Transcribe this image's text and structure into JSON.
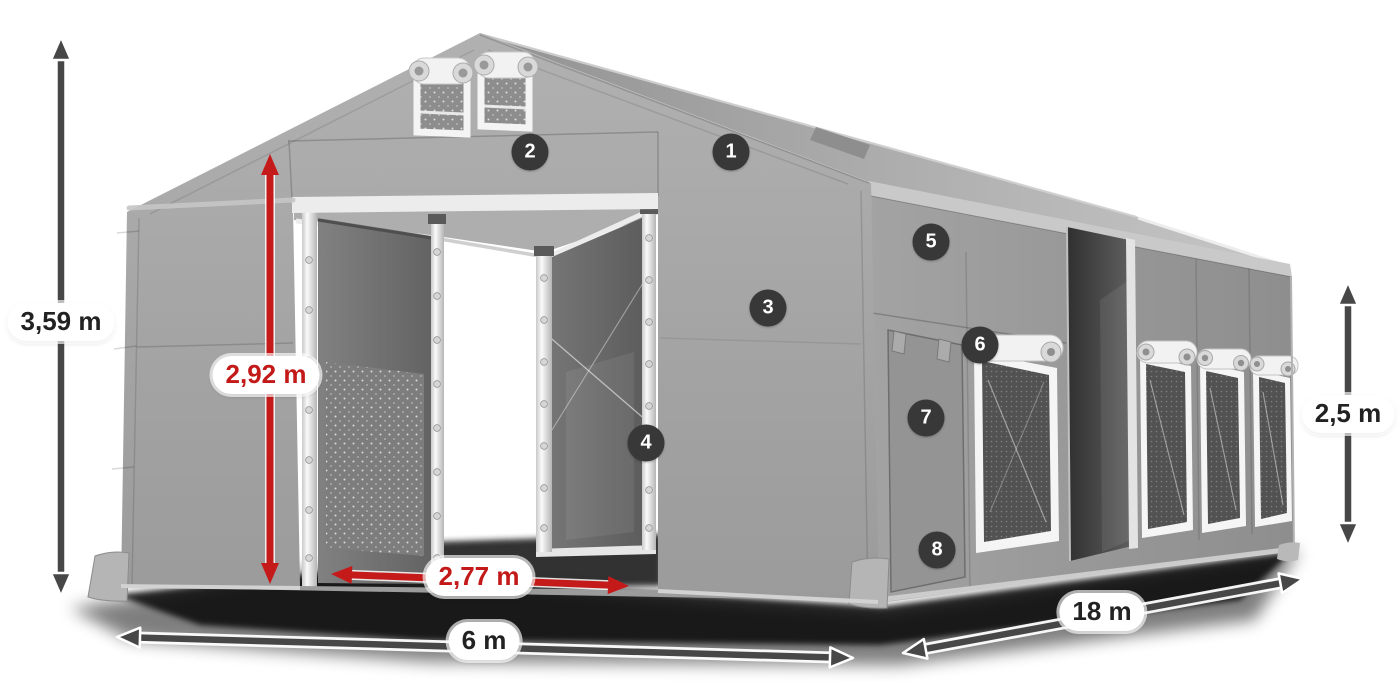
{
  "colors": {
    "accent_red": "#c51a1a",
    "arrow_dark": "#474747",
    "badge_background": "#383838",
    "badge_text": "#ffffff",
    "label_background": "#ffffff",
    "label_text": "#222222",
    "tent_gray": "#a6a6a6"
  },
  "icons": {
    "dimension_arrow_vertical": "↕",
    "dimension_arrow_horizontal": "↔"
  },
  "dimension_labels": {
    "total_height": "3,59 m",
    "entrance_height": "2,92 m",
    "entrance_width": "2,77 m",
    "front_width": "6 m",
    "side_length": "18 m",
    "side_wall_height": "2,5 m"
  },
  "feature_badges": [
    {
      "number": "1"
    },
    {
      "number": "2"
    },
    {
      "number": "3"
    },
    {
      "number": "4"
    },
    {
      "number": "5"
    },
    {
      "number": "6"
    },
    {
      "number": "7"
    },
    {
      "number": "8"
    }
  ]
}
